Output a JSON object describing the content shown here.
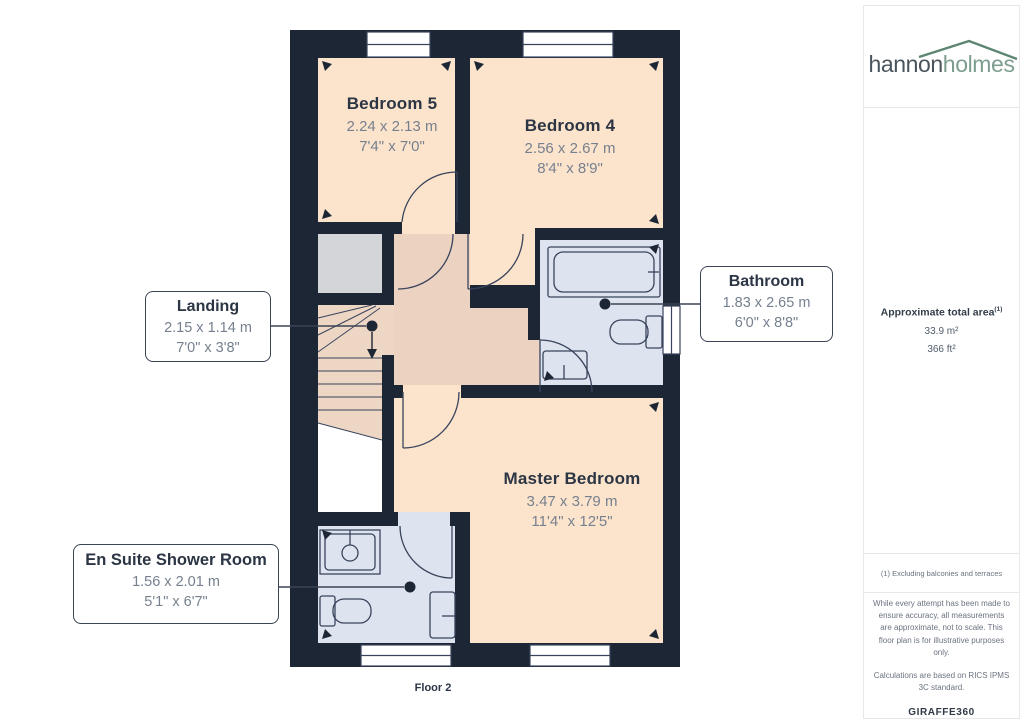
{
  "floorplan": {
    "floor_label": "Floor 2",
    "rooms": [
      {
        "name": "Bedroom 5",
        "metric": "2.24 x 2.13 m",
        "imperial": "7'4\" x 7'0\""
      },
      {
        "name": "Bedroom 4",
        "metric": "2.56 x 2.67 m",
        "imperial": "8'4\" x 8'9\""
      },
      {
        "name": "Master Bedroom",
        "metric": "3.47 x 3.79 m",
        "imperial": "11'4\" x 12'5\""
      }
    ],
    "callouts": [
      {
        "name": "Landing",
        "metric": "2.15 x 1.14 m",
        "imperial": "7'0\" x 3'8\""
      },
      {
        "name": "Bathroom",
        "metric": "1.83 x 2.65 m",
        "imperial": "6'0\" x 8'8\""
      },
      {
        "name": "En Suite Shower Room",
        "metric": "1.56 x 2.01 m",
        "imperial": "5'1\" x 6'7\""
      }
    ]
  },
  "sidebar": {
    "logo": {
      "part1": "hannon",
      "part2": "holmes"
    },
    "area": {
      "title": "Approximate total area",
      "superscript": "(1)",
      "metric": "33.9 m²",
      "imperial": "366 ft²"
    },
    "footnote": "(1) Excluding balconies and terraces",
    "disclaimer1": "While every attempt has been made to ensure accuracy, all measurements are approximate, not to scale. This floor plan is for illustrative purposes only.",
    "disclaimer2": "Calculations are based on RICS IPMS 3C standard.",
    "brand": {
      "part1": "GIRAFFE",
      "part2": "360"
    }
  },
  "colors": {
    "wall": "#1d2635",
    "room_fill": "#fce4cc",
    "hall_fill": "#ecd2c1",
    "wet_fill": "#dee4ef",
    "closet_fill": "#d3d5d8",
    "logo_dark": "#49545c",
    "logo_green": "#7d9e8e",
    "text_dark": "#2b3544",
    "text_gray": "#76808f"
  }
}
